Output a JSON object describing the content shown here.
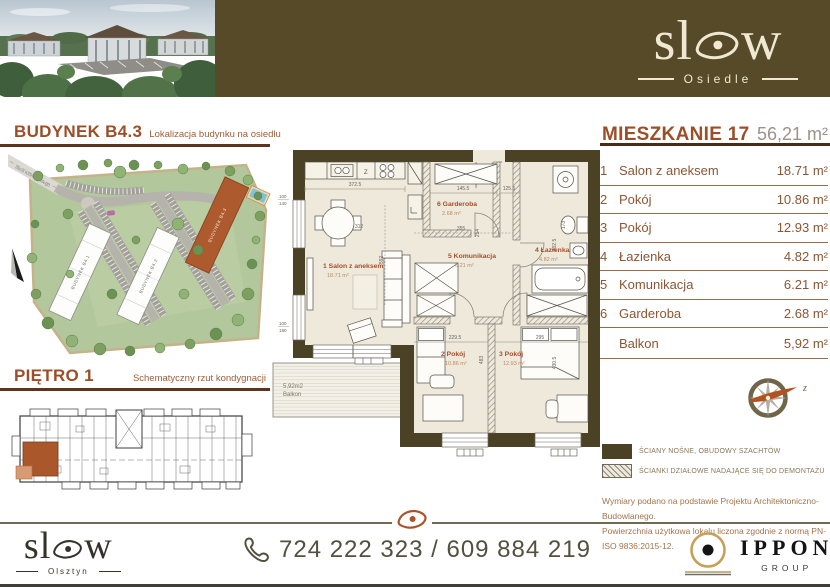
{
  "brand": {
    "word": "slow",
    "osiedle": "Osiedle",
    "olsztyn": "Olsztyn"
  },
  "sections": {
    "building_title": "BUDYNEK B4.3",
    "building_subtitle": "Lokalizacja budynku na osiedlu",
    "floor_title": "PIĘTRO 1",
    "floor_subtitle": "Schematyczny rzut kondygnacji"
  },
  "map": {
    "street": "ulica Klonowskiego",
    "b1": "BUDYNEK B4.1",
    "b2": "BUDYNEK B4.2",
    "b3": "BUDYNEK B4.3"
  },
  "apartment": {
    "title": "MIESZKANIE 17",
    "total_area": "56,21 m²",
    "rooms": [
      {
        "no": "1",
        "name": "Salon z aneksem",
        "area": "18.71 m²"
      },
      {
        "no": "2",
        "name": "Pokój",
        "area": "10.86 m²"
      },
      {
        "no": "3",
        "name": "Pokój",
        "area": "12.93 m²"
      },
      {
        "no": "4",
        "name": "Łazienka",
        "area": "4.82 m²"
      },
      {
        "no": "5",
        "name": "Komunikacja",
        "area": "6.21 m²"
      },
      {
        "no": "6",
        "name": "Garderoba",
        "area": "2.68 m²"
      }
    ],
    "balcony": {
      "name": "Balkon",
      "area": "5,92 m²"
    }
  },
  "plan": {
    "labels": [
      {
        "t": "1 Salon z aneksem",
        "a": "18.71 m²"
      },
      {
        "t": "2 Pokój",
        "a": "10.86 m²"
      },
      {
        "t": "3 Pokój",
        "a": "12.93 m²"
      },
      {
        "t": "4 Łazienka",
        "a": "4.82 m²"
      },
      {
        "t": "5 Komunikacja",
        "a": "6.21 m²"
      },
      {
        "t": "6 Garderoba",
        "a": "2.68 m²"
      }
    ],
    "balcony_area": "5,92m2",
    "balcony_name": "Balkon",
    "kitchen_mark": "Z",
    "dims": {
      "a": "372.5",
      "b": "145.5",
      "c": "125.5",
      "d": "312",
      "e": "355",
      "f": "254",
      "g": "302.5",
      "h": "592",
      "i": "229.5",
      "j": "483",
      "k": "295",
      "l": "430.5",
      "m": "173",
      "w1t": "100",
      "w1b": "140",
      "w2t": "100",
      "w2b": "180"
    }
  },
  "compass_label": "z",
  "legend": {
    "solid": "ŚCIANY NOŚNE, OBUDOWY SZACHTÓW",
    "hatch": "ŚCIANKI DZIAŁOWE NADAJĄCE SIĘ DO DEMONTAŻU"
  },
  "notes": {
    "line1": "Wymiary podano na podstawie Projektu Architektoniczno-Budowlanego.",
    "line2": "Powierzchnia użytkowa lokalu liczona zgodnie z normą PN-ISO 9836:2015-12."
  },
  "footer": {
    "phone": "724 222 323 / 609 884 219",
    "partner_name": "IPPON",
    "partner_sub": "GROUP"
  }
}
